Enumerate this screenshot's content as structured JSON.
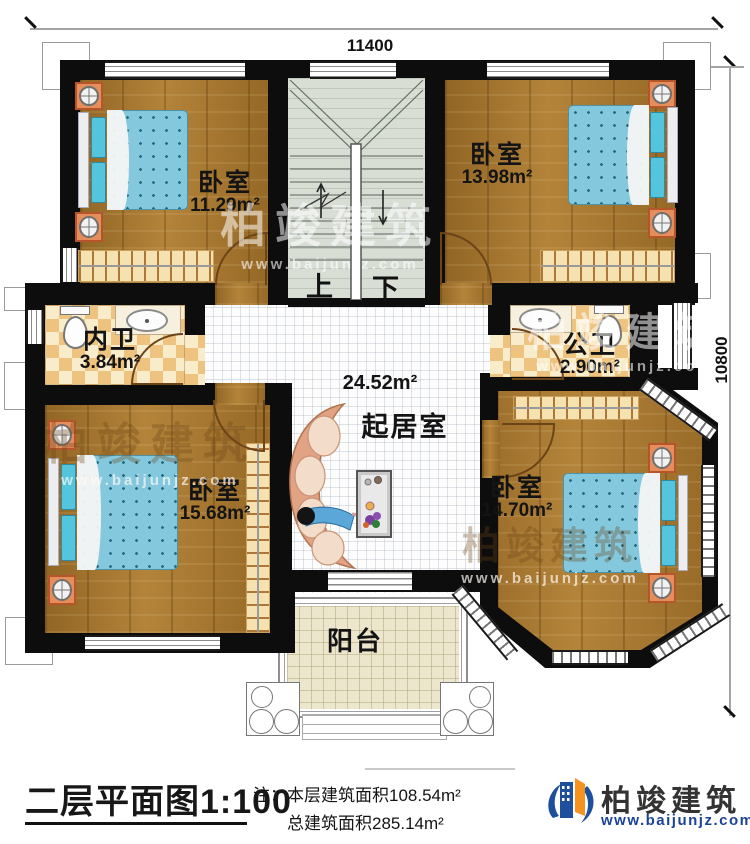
{
  "dims": {
    "top": "11400",
    "right": "10800"
  },
  "rooms": [
    {
      "id": "bedroom-top-left",
      "name": "卧室",
      "area": "11.29m²"
    },
    {
      "id": "bedroom-top-right",
      "name": "卧室",
      "area": "13.98m²"
    },
    {
      "id": "inner-bathroom",
      "name": "内卫",
      "area": "3.84m²"
    },
    {
      "id": "public-bathroom",
      "name": "公卫",
      "area": "2.90m²"
    },
    {
      "id": "bedroom-bottom-left",
      "name": "卧室",
      "area": "15.68m²"
    },
    {
      "id": "bedroom-bottom-right",
      "name": "卧室",
      "area": "14.70m²"
    },
    {
      "id": "living-room",
      "name": "起居室",
      "area": "24.52m²"
    },
    {
      "id": "balcony",
      "name": "阳台"
    }
  ],
  "stairs": {
    "up": "上",
    "down": "下"
  },
  "title_block": {
    "title": "二层平面图",
    "scale": "1:100",
    "note_prefix": "注：",
    "note_line1": "本层建筑面积108.54m²",
    "note_line2": "总建筑面积285.14m²"
  },
  "logo": {
    "name": "柏竣建筑",
    "url": "www.baijunjz.com"
  },
  "watermark": {
    "name": "柏竣建筑",
    "url": "www.baijunjz.com"
  }
}
